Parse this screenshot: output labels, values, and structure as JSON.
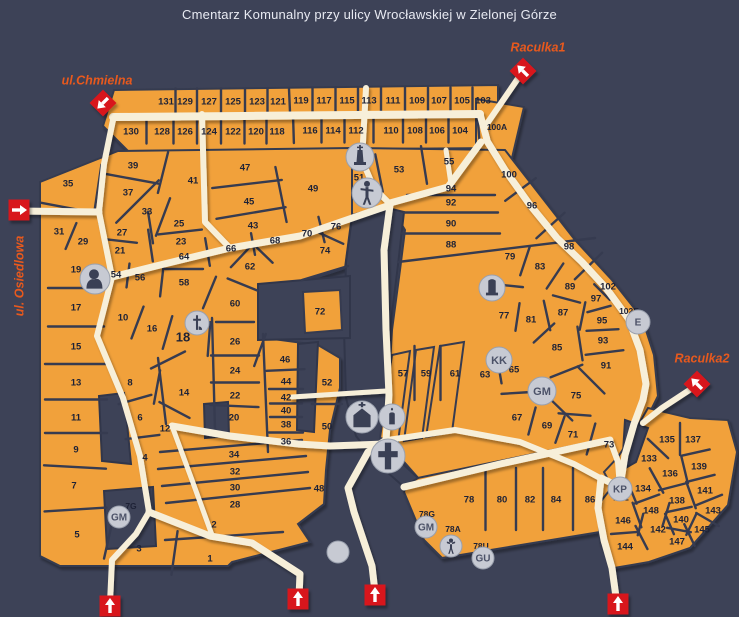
{
  "title": "Cmentarz Komunalny przy ulicy Wrocławskiej w Zielonej Górze",
  "colors": {
    "background": "#3d4257",
    "section_orange": "#f1a13a",
    "path_cream": "#f7efd9",
    "border_dark": "#363b50",
    "entrance_red": "#d8161e",
    "marker_gray": "#c7cad3",
    "street_label": "#e8591d",
    "number_text": "#1e2236",
    "title_text": "#e8eaf2"
  },
  "streets": [
    {
      "label": "ul.Chmielna",
      "x": 97,
      "y": 80,
      "rotate": 0
    },
    {
      "label": "ul. Osiedlowa",
      "x": 19,
      "y": 276,
      "rotate": -90
    },
    {
      "label": "Raculka1",
      "x": 538,
      "y": 47,
      "rotate": 0
    },
    {
      "label": "Raculka2",
      "x": 702,
      "y": 358,
      "rotate": 0
    }
  ],
  "entrances": [
    {
      "shape": "diamond",
      "x": 103,
      "y": 103,
      "dir": "sw"
    },
    {
      "shape": "diamond",
      "x": 523,
      "y": 71,
      "dir": "nw"
    },
    {
      "shape": "diamond",
      "x": 697,
      "y": 384,
      "dir": "nw"
    },
    {
      "shape": "square",
      "x": 19,
      "y": 210,
      "dir": "e"
    },
    {
      "shape": "square",
      "x": 110,
      "y": 606,
      "dir": "n"
    },
    {
      "shape": "square",
      "x": 298,
      "y": 599,
      "dir": "n"
    },
    {
      "shape": "square",
      "x": 375,
      "y": 595,
      "dir": "n"
    },
    {
      "shape": "square",
      "x": 618,
      "y": 604,
      "dir": "n"
    }
  ],
  "icons": [
    {
      "kind": "bust",
      "x": 95,
      "y": 279,
      "r": 15
    },
    {
      "kind": "monument",
      "x": 360,
      "y": 157,
      "r": 14
    },
    {
      "kind": "statue",
      "x": 367,
      "y": 193,
      "r": 15
    },
    {
      "kind": "pieta",
      "x": 197,
      "y": 323,
      "r": 12
    },
    {
      "kind": "monument2",
      "x": 492,
      "y": 288,
      "r": 13
    },
    {
      "kind": "letters",
      "text": "KK",
      "x": 499,
      "y": 360,
      "r": 13
    },
    {
      "kind": "letters",
      "text": "GM",
      "x": 542,
      "y": 391,
      "r": 14
    },
    {
      "kind": "letters",
      "text": "E",
      "x": 638,
      "y": 322,
      "r": 12
    },
    {
      "kind": "letters",
      "text": "KP",
      "x": 620,
      "y": 489,
      "r": 12
    },
    {
      "kind": "chapel",
      "x": 362,
      "y": 417,
      "r": 16
    },
    {
      "kind": "candle",
      "x": 392,
      "y": 417,
      "r": 13
    },
    {
      "kind": "cross",
      "x": 388,
      "y": 456,
      "r": 17
    },
    {
      "kind": "letters",
      "text": "GM",
      "x": 119,
      "y": 517,
      "r": 11
    },
    {
      "kind": "letters",
      "text": "GM",
      "x": 426,
      "y": 527,
      "r": 11
    },
    {
      "kind": "figure",
      "x": 451,
      "y": 546,
      "r": 11
    },
    {
      "kind": "letters",
      "text": "GU",
      "x": 483,
      "y": 558,
      "r": 11
    },
    {
      "kind": "plain",
      "x": 338,
      "y": 552,
      "r": 11
    }
  ],
  "sections": [
    {
      "label": "131",
      "x": 166,
      "y": 101
    },
    {
      "label": "129",
      "x": 185,
      "y": 101
    },
    {
      "label": "127",
      "x": 209,
      "y": 101
    },
    {
      "label": "125",
      "x": 233,
      "y": 101
    },
    {
      "label": "123",
      "x": 257,
      "y": 101
    },
    {
      "label": "121",
      "x": 278,
      "y": 101
    },
    {
      "label": "119",
      "x": 301,
      "y": 100
    },
    {
      "label": "117",
      "x": 324,
      "y": 100
    },
    {
      "label": "115",
      "x": 347,
      "y": 100
    },
    {
      "label": "113",
      "x": 369,
      "y": 100
    },
    {
      "label": "111",
      "x": 393,
      "y": 100
    },
    {
      "label": "109",
      "x": 417,
      "y": 100
    },
    {
      "label": "107",
      "x": 439,
      "y": 100
    },
    {
      "label": "105",
      "x": 462,
      "y": 100
    },
    {
      "label": "103",
      "x": 483,
      "y": 100
    },
    {
      "label": "130",
      "x": 131,
      "y": 131
    },
    {
      "label": "128",
      "x": 162,
      "y": 131
    },
    {
      "label": "126",
      "x": 185,
      "y": 131
    },
    {
      "label": "124",
      "x": 209,
      "y": 131
    },
    {
      "label": "122",
      "x": 233,
      "y": 131
    },
    {
      "label": "120",
      "x": 256,
      "y": 131
    },
    {
      "label": "118",
      "x": 277,
      "y": 131
    },
    {
      "label": "116",
      "x": 310,
      "y": 130
    },
    {
      "label": "114",
      "x": 333,
      "y": 130
    },
    {
      "label": "112",
      "x": 356,
      "y": 130
    },
    {
      "label": "110",
      "x": 391,
      "y": 130
    },
    {
      "label": "108",
      "x": 415,
      "y": 130
    },
    {
      "label": "106",
      "x": 437,
      "y": 130
    },
    {
      "label": "104",
      "x": 460,
      "y": 130
    },
    {
      "label": "100A",
      "x": 497,
      "y": 127,
      "size": 8.5
    },
    {
      "label": "35",
      "x": 68,
      "y": 183
    },
    {
      "label": "39",
      "x": 133,
      "y": 165
    },
    {
      "label": "41",
      "x": 193,
      "y": 180
    },
    {
      "label": "47",
      "x": 245,
      "y": 167
    },
    {
      "label": "37",
      "x": 128,
      "y": 192
    },
    {
      "label": "45",
      "x": 249,
      "y": 201
    },
    {
      "label": "33",
      "x": 147,
      "y": 211
    },
    {
      "label": "25",
      "x": 179,
      "y": 223
    },
    {
      "label": "43",
      "x": 253,
      "y": 225
    },
    {
      "label": "31",
      "x": 59,
      "y": 231
    },
    {
      "label": "27",
      "x": 122,
      "y": 232
    },
    {
      "label": "29",
      "x": 83,
      "y": 241
    },
    {
      "label": "21",
      "x": 120,
      "y": 250
    },
    {
      "label": "23",
      "x": 181,
      "y": 241
    },
    {
      "label": "66",
      "x": 231,
      "y": 248
    },
    {
      "label": "68",
      "x": 275,
      "y": 240
    },
    {
      "label": "64",
      "x": 184,
      "y": 256
    },
    {
      "label": "62",
      "x": 250,
      "y": 266
    },
    {
      "label": "19",
      "x": 76,
      "y": 269
    },
    {
      "label": "54",
      "x": 116,
      "y": 274
    },
    {
      "label": "56",
      "x": 140,
      "y": 277
    },
    {
      "label": "58",
      "x": 184,
      "y": 282
    },
    {
      "label": "17",
      "x": 76,
      "y": 307
    },
    {
      "label": "60",
      "x": 235,
      "y": 303
    },
    {
      "label": "10",
      "x": 123,
      "y": 317
    },
    {
      "label": "16",
      "x": 152,
      "y": 328
    },
    {
      "label": "18",
      "x": 183,
      "y": 337,
      "size": 13
    },
    {
      "label": "72",
      "x": 320,
      "y": 311
    },
    {
      "label": "15",
      "x": 76,
      "y": 346
    },
    {
      "label": "26",
      "x": 235,
      "y": 341
    },
    {
      "label": "46",
      "x": 285,
      "y": 359
    },
    {
      "label": "13",
      "x": 76,
      "y": 382
    },
    {
      "label": "8",
      "x": 130,
      "y": 382
    },
    {
      "label": "24",
      "x": 235,
      "y": 370
    },
    {
      "label": "44",
      "x": 286,
      "y": 381
    },
    {
      "label": "52",
      "x": 327,
      "y": 382
    },
    {
      "label": "14",
      "x": 184,
      "y": 392
    },
    {
      "label": "22",
      "x": 235,
      "y": 395
    },
    {
      "label": "42",
      "x": 286,
      "y": 397
    },
    {
      "label": "11",
      "x": 76,
      "y": 417
    },
    {
      "label": "6",
      "x": 140,
      "y": 417
    },
    {
      "label": "20",
      "x": 234,
      "y": 417
    },
    {
      "label": "40",
      "x": 286,
      "y": 410
    },
    {
      "label": "38",
      "x": 286,
      "y": 424
    },
    {
      "label": "12",
      "x": 165,
      "y": 428
    },
    {
      "label": "50",
      "x": 327,
      "y": 426
    },
    {
      "label": "36",
      "x": 286,
      "y": 441
    },
    {
      "label": "9",
      "x": 76,
      "y": 449
    },
    {
      "label": "4",
      "x": 145,
      "y": 457
    },
    {
      "label": "34",
      "x": 234,
      "y": 454
    },
    {
      "label": "32",
      "x": 235,
      "y": 471
    },
    {
      "label": "7",
      "x": 74,
      "y": 485
    },
    {
      "label": "30",
      "x": 235,
      "y": 487
    },
    {
      "label": "48",
      "x": 319,
      "y": 488
    },
    {
      "label": "28",
      "x": 235,
      "y": 504
    },
    {
      "label": "3",
      "x": 139,
      "y": 548
    },
    {
      "label": "2",
      "x": 214,
      "y": 524
    },
    {
      "label": "1",
      "x": 210,
      "y": 558
    },
    {
      "label": "5",
      "x": 77,
      "y": 534
    },
    {
      "label": "7G",
      "x": 131,
      "y": 506,
      "size": 8.5
    },
    {
      "label": "78G",
      "x": 427,
      "y": 514,
      "size": 8.5
    },
    {
      "label": "78A",
      "x": 453,
      "y": 529,
      "size": 8.5
    },
    {
      "label": "78U",
      "x": 481,
      "y": 546,
      "size": 8.5
    },
    {
      "label": "49",
      "x": 313,
      "y": 188
    },
    {
      "label": "51",
      "x": 359,
      "y": 177
    },
    {
      "label": "53",
      "x": 399,
      "y": 169
    },
    {
      "label": "55",
      "x": 449,
      "y": 161
    },
    {
      "label": "100",
      "x": 509,
      "y": 174
    },
    {
      "label": "94",
      "x": 451,
      "y": 188
    },
    {
      "label": "92",
      "x": 451,
      "y": 202
    },
    {
      "label": "96",
      "x": 532,
      "y": 205
    },
    {
      "label": "90",
      "x": 451,
      "y": 223
    },
    {
      "label": "88",
      "x": 451,
      "y": 244
    },
    {
      "label": "76",
      "x": 336,
      "y": 226
    },
    {
      "label": "70",
      "x": 307,
      "y": 233
    },
    {
      "label": "74",
      "x": 325,
      "y": 250
    },
    {
      "label": "98",
      "x": 569,
      "y": 246
    },
    {
      "label": "79",
      "x": 510,
      "y": 256
    },
    {
      "label": "83",
      "x": 540,
      "y": 266
    },
    {
      "label": "89",
      "x": 570,
      "y": 286
    },
    {
      "label": "102",
      "x": 608,
      "y": 286
    },
    {
      "label": "97",
      "x": 596,
      "y": 298
    },
    {
      "label": "102E",
      "x": 629,
      "y": 311,
      "size": 8.5
    },
    {
      "label": "77",
      "x": 504,
      "y": 315
    },
    {
      "label": "81",
      "x": 531,
      "y": 319
    },
    {
      "label": "87",
      "x": 563,
      "y": 312
    },
    {
      "label": "95",
      "x": 602,
      "y": 320
    },
    {
      "label": "93",
      "x": 603,
      "y": 340
    },
    {
      "label": "85",
      "x": 557,
      "y": 347
    },
    {
      "label": "91",
      "x": 606,
      "y": 365
    },
    {
      "label": "63",
      "x": 485,
      "y": 374
    },
    {
      "label": "65",
      "x": 514,
      "y": 369
    },
    {
      "label": "75",
      "x": 576,
      "y": 395
    },
    {
      "label": "57",
      "x": 403,
      "y": 373
    },
    {
      "label": "59",
      "x": 426,
      "y": 373
    },
    {
      "label": "61",
      "x": 455,
      "y": 373
    },
    {
      "label": "67",
      "x": 517,
      "y": 417
    },
    {
      "label": "69",
      "x": 547,
      "y": 425
    },
    {
      "label": "71",
      "x": 573,
      "y": 434
    },
    {
      "label": "73",
      "x": 609,
      "y": 444
    },
    {
      "label": "78",
      "x": 469,
      "y": 499
    },
    {
      "label": "80",
      "x": 502,
      "y": 499
    },
    {
      "label": "82",
      "x": 530,
      "y": 499
    },
    {
      "label": "84",
      "x": 556,
      "y": 499
    },
    {
      "label": "86",
      "x": 590,
      "y": 499
    },
    {
      "label": "135",
      "x": 667,
      "y": 439
    },
    {
      "label": "137",
      "x": 693,
      "y": 439
    },
    {
      "label": "133",
      "x": 649,
      "y": 458
    },
    {
      "label": "139",
      "x": 699,
      "y": 466
    },
    {
      "label": "136",
      "x": 670,
      "y": 473
    },
    {
      "label": "134",
      "x": 643,
      "y": 488
    },
    {
      "label": "141",
      "x": 705,
      "y": 490
    },
    {
      "label": "132",
      "x": 621,
      "y": 497
    },
    {
      "label": "138",
      "x": 677,
      "y": 500
    },
    {
      "label": "148",
      "x": 651,
      "y": 510
    },
    {
      "label": "143",
      "x": 713,
      "y": 510
    },
    {
      "label": "146",
      "x": 623,
      "y": 520
    },
    {
      "label": "140",
      "x": 681,
      "y": 519
    },
    {
      "label": "142",
      "x": 658,
      "y": 529
    },
    {
      "label": "145",
      "x": 702,
      "y": 529
    },
    {
      "label": "144",
      "x": 625,
      "y": 546
    },
    {
      "label": "147",
      "x": 677,
      "y": 541
    }
  ]
}
